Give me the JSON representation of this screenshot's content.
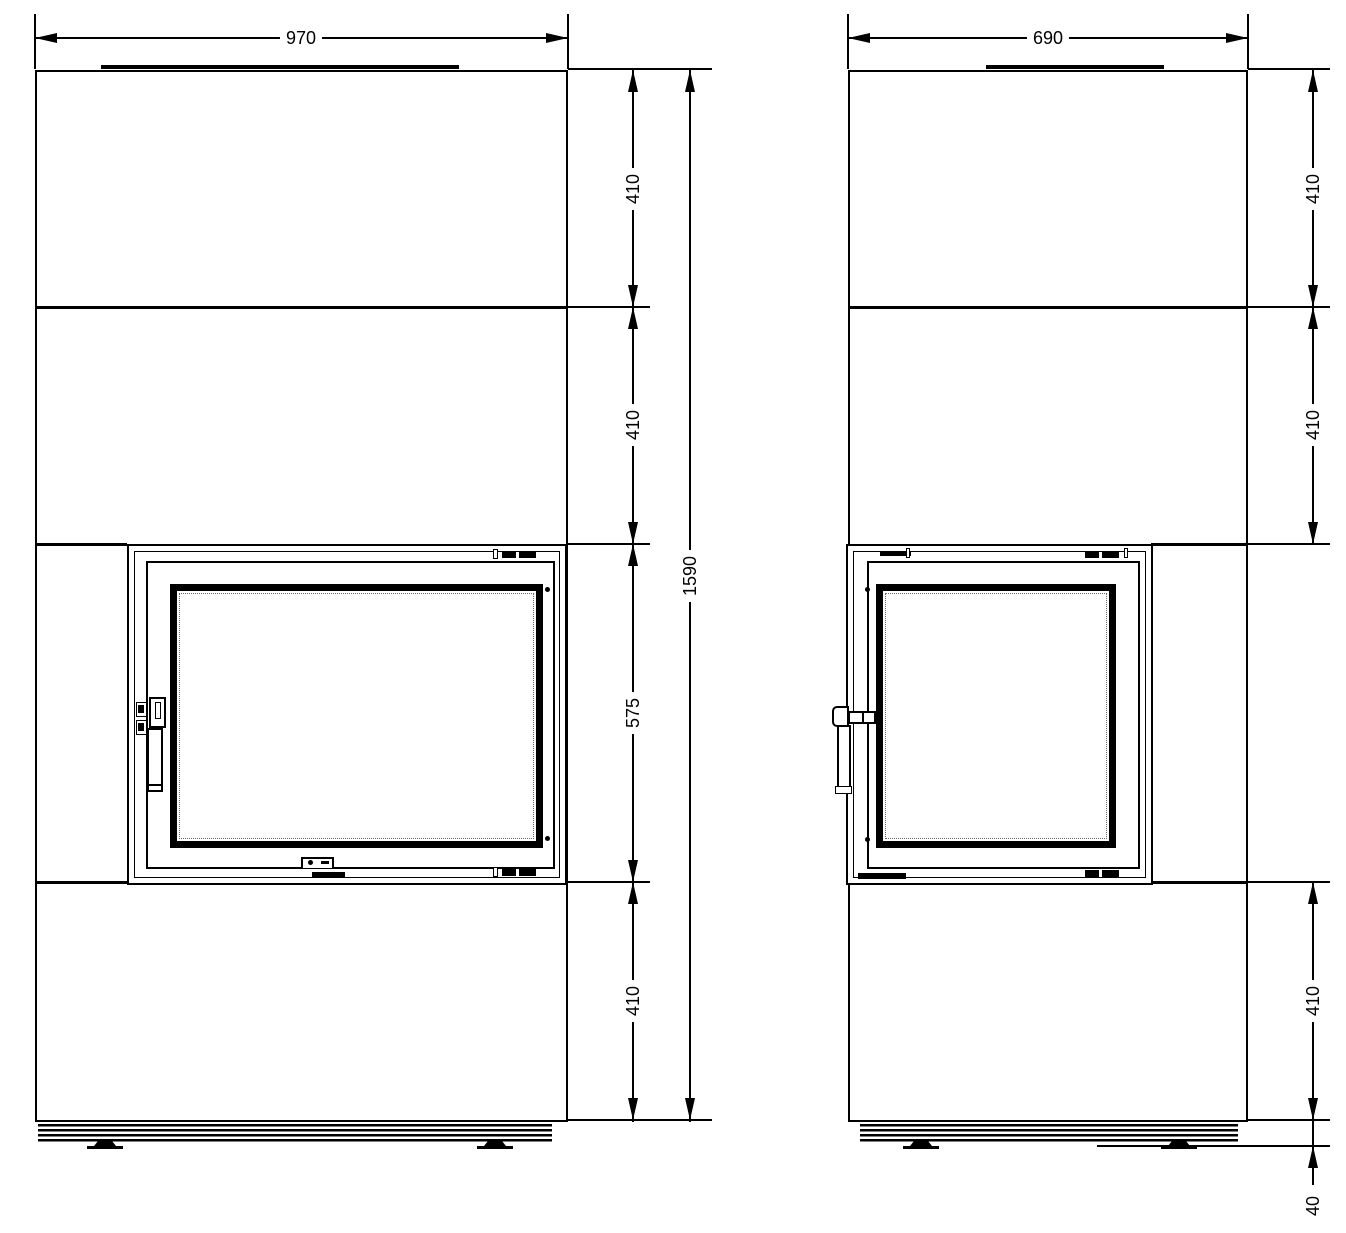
{
  "colors": {
    "line": "#000000",
    "background": "#ffffff",
    "glass_frame": "#000000"
  },
  "dimensions": {
    "front_view": {
      "width": "970",
      "overall_height": "1590",
      "height_segments": [
        "410",
        "410",
        "575",
        "410"
      ]
    },
    "side_view": {
      "depth": "690",
      "height_segments": [
        "410",
        "410",
        "410"
      ],
      "plinth_height": "40"
    }
  }
}
